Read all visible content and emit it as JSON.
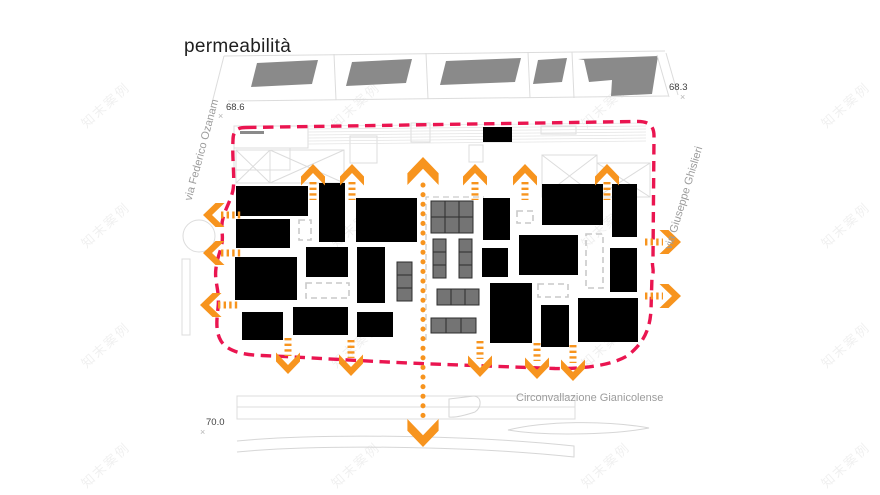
{
  "title": "permeabilità",
  "watermark": "知末案例",
  "labels": {
    "street_left": "via Federico Ozanam",
    "street_right": "via Giuseppe Ghislieri",
    "street_bottom": "Circonvallazione Gianicolense",
    "elev_top_left": "68.6",
    "elev_top_right": "68.3",
    "elev_bottom_left": "70.0",
    "marker": "×"
  },
  "colors": {
    "arrow_orange": "#F7941E",
    "boundary_red": "#EA1550",
    "building_black": "#000000",
    "context_building_gray": "#8A8A8A",
    "module_gray": "#747474",
    "module_stroke": "#2D2D2D",
    "outline_light": "#DCDCDC",
    "dashed_light": "#C9C9C9",
    "text_gray": "#9C9C9C",
    "text_dark": "#1F1F1F"
  },
  "plan": {
    "black_buildings": [
      [
        236,
        186,
        72,
        30
      ],
      [
        236,
        219,
        54,
        29
      ],
      [
        319,
        183,
        26,
        59
      ],
      [
        356,
        198,
        61,
        44
      ],
      [
        483,
        198,
        27,
        42
      ],
      [
        542,
        184,
        61,
        41
      ],
      [
        612,
        184,
        25,
        53
      ],
      [
        235,
        257,
        62,
        43
      ],
      [
        306,
        247,
        42,
        30
      ],
      [
        357,
        247,
        28,
        56
      ],
      [
        482,
        248,
        26,
        29
      ],
      [
        519,
        235,
        59,
        40
      ],
      [
        610,
        248,
        27,
        44
      ],
      [
        242,
        312,
        41,
        28
      ],
      [
        293,
        307,
        55,
        28
      ],
      [
        357,
        312,
        36,
        25
      ],
      [
        490,
        283,
        42,
        60
      ],
      [
        541,
        305,
        28,
        42
      ],
      [
        578,
        298,
        60,
        44
      ],
      [
        483,
        127,
        29,
        15
      ]
    ],
    "module_groups": [
      {
        "x": 431,
        "y": 201,
        "cols": 3,
        "rows": 2,
        "cw": 14,
        "ch": 16
      },
      {
        "x": 433,
        "y": 239,
        "cols": 1,
        "rows": 3,
        "cw": 13,
        "ch": 13
      },
      {
        "x": 459,
        "y": 239,
        "cols": 1,
        "rows": 3,
        "cw": 13,
        "ch": 13
      },
      {
        "x": 437,
        "y": 289,
        "cols": 3,
        "rows": 1,
        "cw": 14,
        "ch": 16
      },
      {
        "x": 431,
        "y": 318,
        "cols": 3,
        "rows": 1,
        "cw": 15,
        "ch": 15
      },
      {
        "x": 397,
        "y": 262,
        "cols": 1,
        "rows": 3,
        "cw": 15,
        "ch": 13
      }
    ],
    "dashed_boxes": [
      [
        299,
        220,
        12,
        20
      ],
      [
        306,
        283,
        43,
        15
      ],
      [
        538,
        284,
        30,
        13
      ],
      [
        517,
        211,
        16,
        12
      ],
      [
        586,
        234,
        17,
        54
      ]
    ],
    "dashed_polylines": [
      "M426,340 L426,197 L484,197"
    ],
    "parallelograms": [
      "257,63 318,60 312,84 251,87",
      "352,62 412,59 406,83 346,86",
      "446,61 521,58 515,82 440,85",
      "538,60 567,58 562,82 533,84",
      "578,59 658,56 652,94 611,96 612,80 589,82 584,60"
    ],
    "context_lines": [
      "M224,56 L665,51",
      "M212,103 L224,56",
      "M228,101 L668,96",
      "M334,54 L336,100",
      "M426,53 L428,99",
      "M528,52 L530,98",
      "M572,52 L574,98",
      "M657,55 L669,97",
      "M666,53 L678,95"
    ],
    "context_rects": [
      [
        234,
        126,
        74,
        22
      ],
      [
        234,
        148,
        56,
        22
      ],
      [
        350,
        136,
        27,
        27
      ],
      [
        411,
        123,
        19,
        19
      ],
      [
        469,
        145,
        14,
        17
      ],
      [
        541,
        126,
        35,
        8
      ],
      [
        182,
        259,
        8,
        76
      ],
      [
        237,
        396,
        338,
        11
      ],
      [
        237,
        407,
        338,
        12
      ]
    ],
    "context_fill_rects": [
      [
        240,
        131,
        24,
        3
      ]
    ],
    "hatch_band": {
      "x1": 308,
      "x2": 646,
      "y0": 126,
      "dy": 3,
      "n": 7
    },
    "x_boxes": [
      [
        236,
        150,
        34,
        33
      ],
      [
        270,
        150,
        74,
        33
      ],
      [
        542,
        155,
        55,
        42
      ],
      [
        597,
        163,
        53,
        34
      ]
    ],
    "ellipse": {
      "cx": 199,
      "cy": 236,
      "rx": 16,
      "ry": 16
    },
    "context_paths": [
      "M237,441 C320,433 470,435 574,446 L574,457 C470,446 320,444 237,452",
      "M449,399 L474,396 C482,397 482,407 475,412 C466,415 456,418 449,417 Z",
      "M508,430 C545,421 605,420 649,428 C612,435 543,436 508,430 Z"
    ],
    "boundary_path": "M246,127.5 L636,121.5 C648,121 654,125 654,136 L653,258 C651,266 655,270 652,276 L651,310 C650,330 643,344 627,356 C610,366 580,369 555,368.5 L420,363.5 C360,361 300,357 262,355.5 C245,355 228,352 221,341 C215,331 217,318 218,308 C220,290 214,282 216,268 C218,252 224,247 222,232 C220,215 230,205 233,190 C235,178 232,160 233,140 C233,130 238,127.5 246,127.5 Z",
    "axis": {
      "x": 423,
      "y1": 185,
      "y2": 424
    },
    "arrows": {
      "up": [
        [
          313,
          164
        ],
        [
          352,
          164
        ],
        [
          475,
          164
        ],
        [
          525,
          164
        ],
        [
          607,
          164
        ]
      ],
      "main_up": [
        423,
        157
      ],
      "down": [
        [
          288,
          374
        ],
        [
          351,
          376
        ],
        [
          480,
          377
        ],
        [
          537,
          379
        ],
        [
          573,
          381
        ]
      ],
      "main_down": [
        423,
        447
      ],
      "left": [
        [
          203,
          215
        ],
        [
          203,
          253
        ],
        [
          200,
          305
        ]
      ],
      "right": [
        [
          681,
          242
        ],
        [
          681,
          296
        ]
      ]
    },
    "watermark_positions": [
      [
        105,
        95
      ],
      [
        355,
        95
      ],
      [
        605,
        95
      ],
      [
        845,
        95
      ],
      [
        105,
        215
      ],
      [
        355,
        215
      ],
      [
        605,
        215
      ],
      [
        845,
        215
      ],
      [
        105,
        335
      ],
      [
        355,
        335
      ],
      [
        605,
        335
      ],
      [
        845,
        335
      ],
      [
        105,
        455
      ],
      [
        355,
        455
      ],
      [
        605,
        455
      ],
      [
        845,
        455
      ]
    ]
  }
}
